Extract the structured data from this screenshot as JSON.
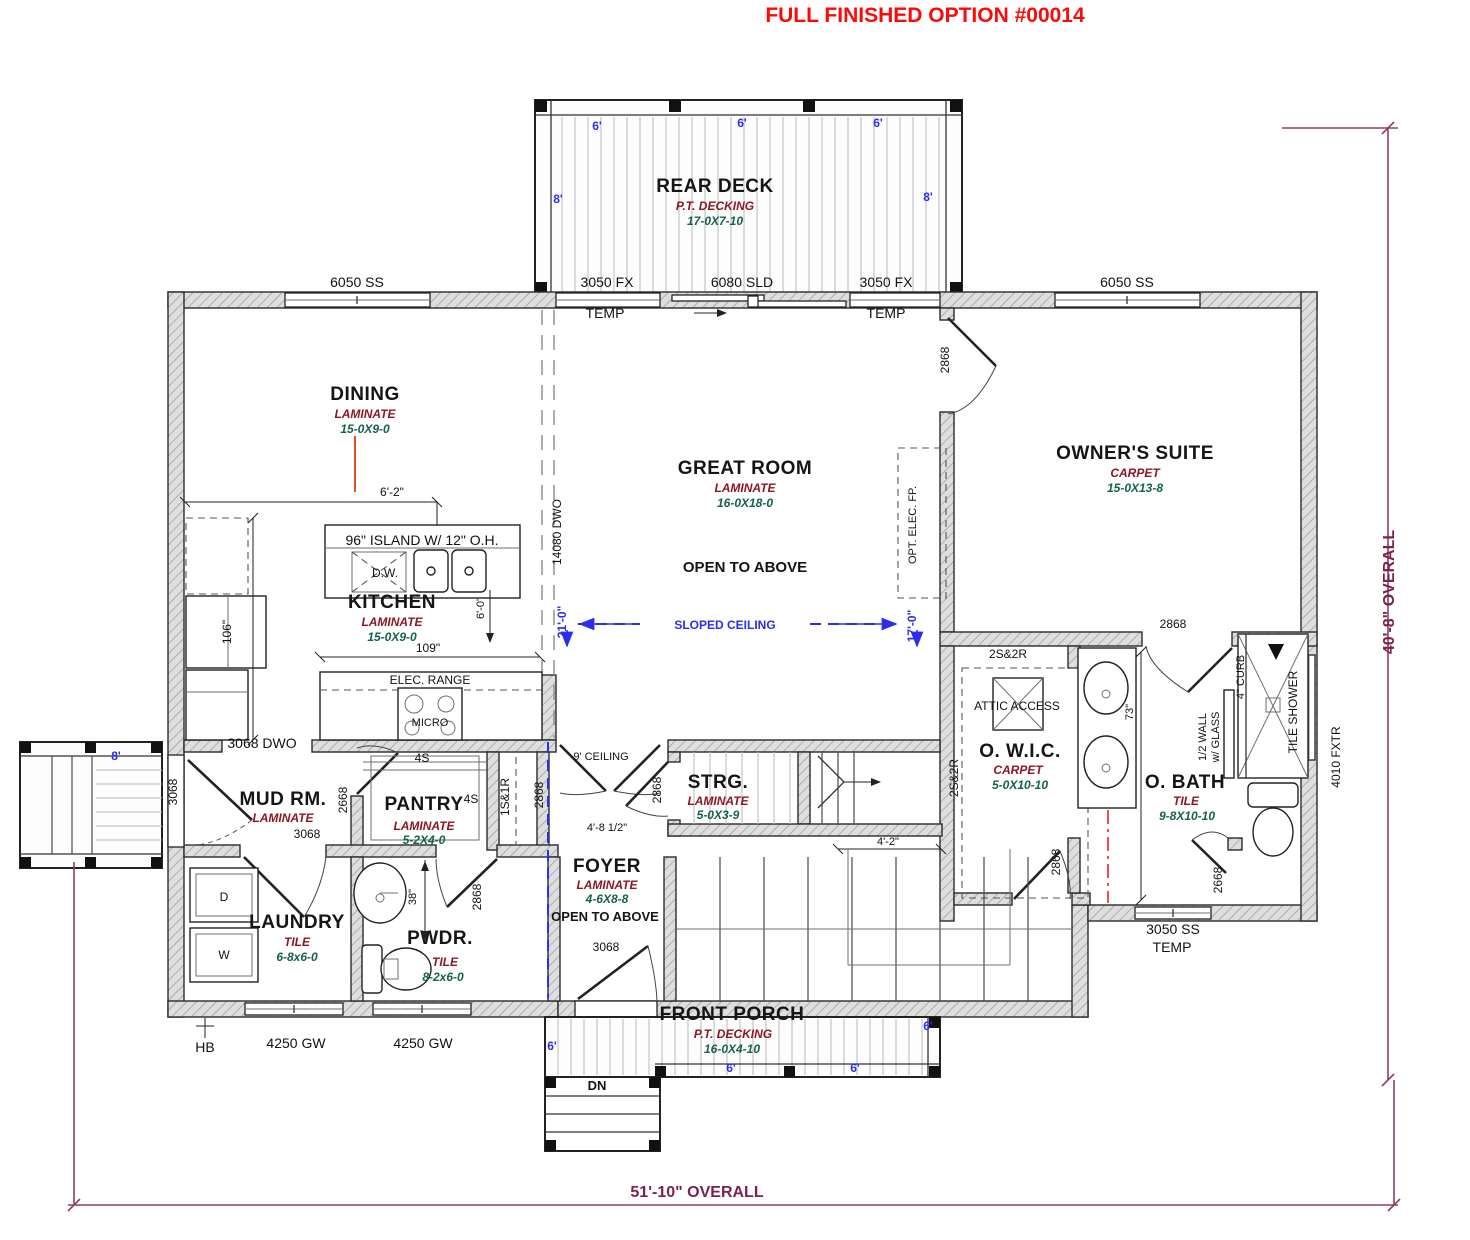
{
  "title": "FULL FINISHED    OPTION #00014",
  "overall": {
    "width_label": "51'-10\" OVERALL",
    "height_label": "40'-8\" OVERALL"
  },
  "rooms": {
    "rear_deck": {
      "name": "REAR DECK",
      "finish": "P.T. DECKING",
      "size": "17-0X7-10"
    },
    "dining": {
      "name": "DINING",
      "finish": "LAMINATE",
      "size": "15-0X9-0"
    },
    "great_room": {
      "name": "GREAT ROOM",
      "finish": "LAMINATE",
      "size": "16-0X18-0",
      "note": "OPEN TO ABOVE"
    },
    "owners_suite": {
      "name": "OWNER'S SUITE",
      "finish": "CARPET",
      "size": "15-0X13-8"
    },
    "kitchen": {
      "name": "KITCHEN",
      "finish": "LAMINATE",
      "size": "15-0X9-0"
    },
    "mud": {
      "name": "MUD RM.",
      "finish": "LAMINATE"
    },
    "pantry": {
      "name": "PANTRY",
      "finish": "LAMINATE",
      "size": "5-2X4-0"
    },
    "strg": {
      "name": "STRG.",
      "finish": "LAMINATE",
      "size": "5-0X3-9"
    },
    "foyer": {
      "name": "FOYER",
      "finish": "LAMINATE",
      "size": "4-6X8-8",
      "note": "OPEN TO ABOVE"
    },
    "laundry": {
      "name": "LAUNDRY",
      "finish": "TILE",
      "size": "6-8x6-0"
    },
    "pwdr": {
      "name": "PWDR.",
      "finish": "TILE",
      "size": "8-2x6-0"
    },
    "wic": {
      "name": "O. W.I.C.",
      "finish": "CARPET",
      "size": "5-0X10-10"
    },
    "obath": {
      "name": "O. BATH",
      "finish": "TILE",
      "size": "9-8X10-10"
    },
    "porch": {
      "name": "FRONT PORCH",
      "finish": "P.T. DECKING",
      "size": "16-0X4-10"
    }
  },
  "openings": {
    "w6050": "6050 SS",
    "w3050fx": "3050 FX",
    "sld": "6080 SLD",
    "w3050ss": "3050 SS",
    "w4250": "4250 GW",
    "fxtr": "4010 FXTR",
    "temp": "TEMP",
    "d2868": "2868",
    "d2668": "2668",
    "d3068": "3068",
    "dwo3068": "3068 DWO",
    "dwo14080": "14080 DWO"
  },
  "annotations": {
    "island": "96\" ISLAND W/ 12\" O.H.",
    "dw": "D.W.",
    "range": "ELEC. RANGE",
    "micro": "MICRO",
    "opt_fp": "OPT. ELEC. FP.",
    "sloped": "SLOPED CEILING",
    "ceiling9": "9' CEILING",
    "attic": "ATTIC ACCESS",
    "s2s2r": "2S&2R",
    "s4s": "4S",
    "s1s1r": "1S&1R",
    "half1": "1/2 WALL",
    "half2": "w/ GLASS",
    "curb": "4\" CURB",
    "tshower": "TILE SHOWER",
    "hb": "HB",
    "dn": "DN",
    "d": "D",
    "w": "W"
  },
  "dims": {
    "d62": "6'-2\"",
    "d60": "6'-0\"",
    "d106": "106\"",
    "d109": "109\"",
    "d38": "38\"",
    "d73": "73\"",
    "d21": "21'-0\"",
    "d17": "17'-0\"",
    "d48": "4'-8 1/2\"",
    "d42": "4'-2\"",
    "ft6": "6'",
    "ft8": "8'"
  }
}
